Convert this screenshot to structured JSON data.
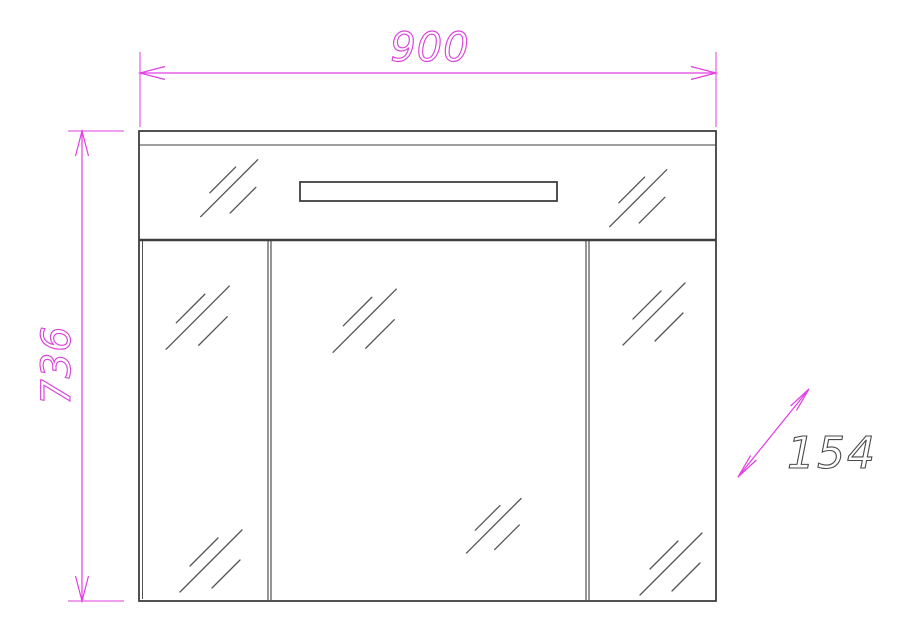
{
  "labels": {
    "width": "900",
    "height": "736",
    "depth": "154"
  },
  "colors": {
    "dimension_accent": "#e23ee2",
    "depth_label": "#4a4a4a",
    "cabinet_outline": "#3f3f3f",
    "mirror_hatch": "#555555",
    "background": "#ffffff"
  }
}
